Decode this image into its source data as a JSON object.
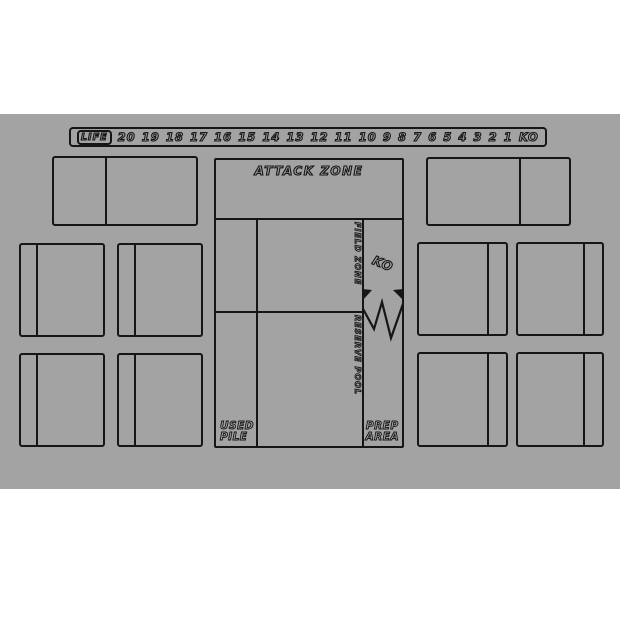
{
  "colors": {
    "page": "#ffffff",
    "mat": "#a3a3a3",
    "line": "#161616"
  },
  "life_track": {
    "label": "LIFE",
    "values": [
      "20",
      "19",
      "18",
      "17",
      "16",
      "15",
      "14",
      "13",
      "12",
      "11",
      "10",
      "9",
      "8",
      "7",
      "6",
      "5",
      "4",
      "3",
      "2",
      "1",
      "KO"
    ]
  },
  "zones": {
    "attack": {
      "label": "ATTACK ZONE"
    },
    "field": {
      "label": "FIELD ZONE"
    },
    "reserve": {
      "label": "RESERVE POOL"
    },
    "ko": {
      "label": "KO"
    },
    "used_pile": {
      "line1": "USED",
      "line2": "PILE"
    },
    "prep_area": {
      "line1": "PREP",
      "line2": "AREA"
    }
  }
}
